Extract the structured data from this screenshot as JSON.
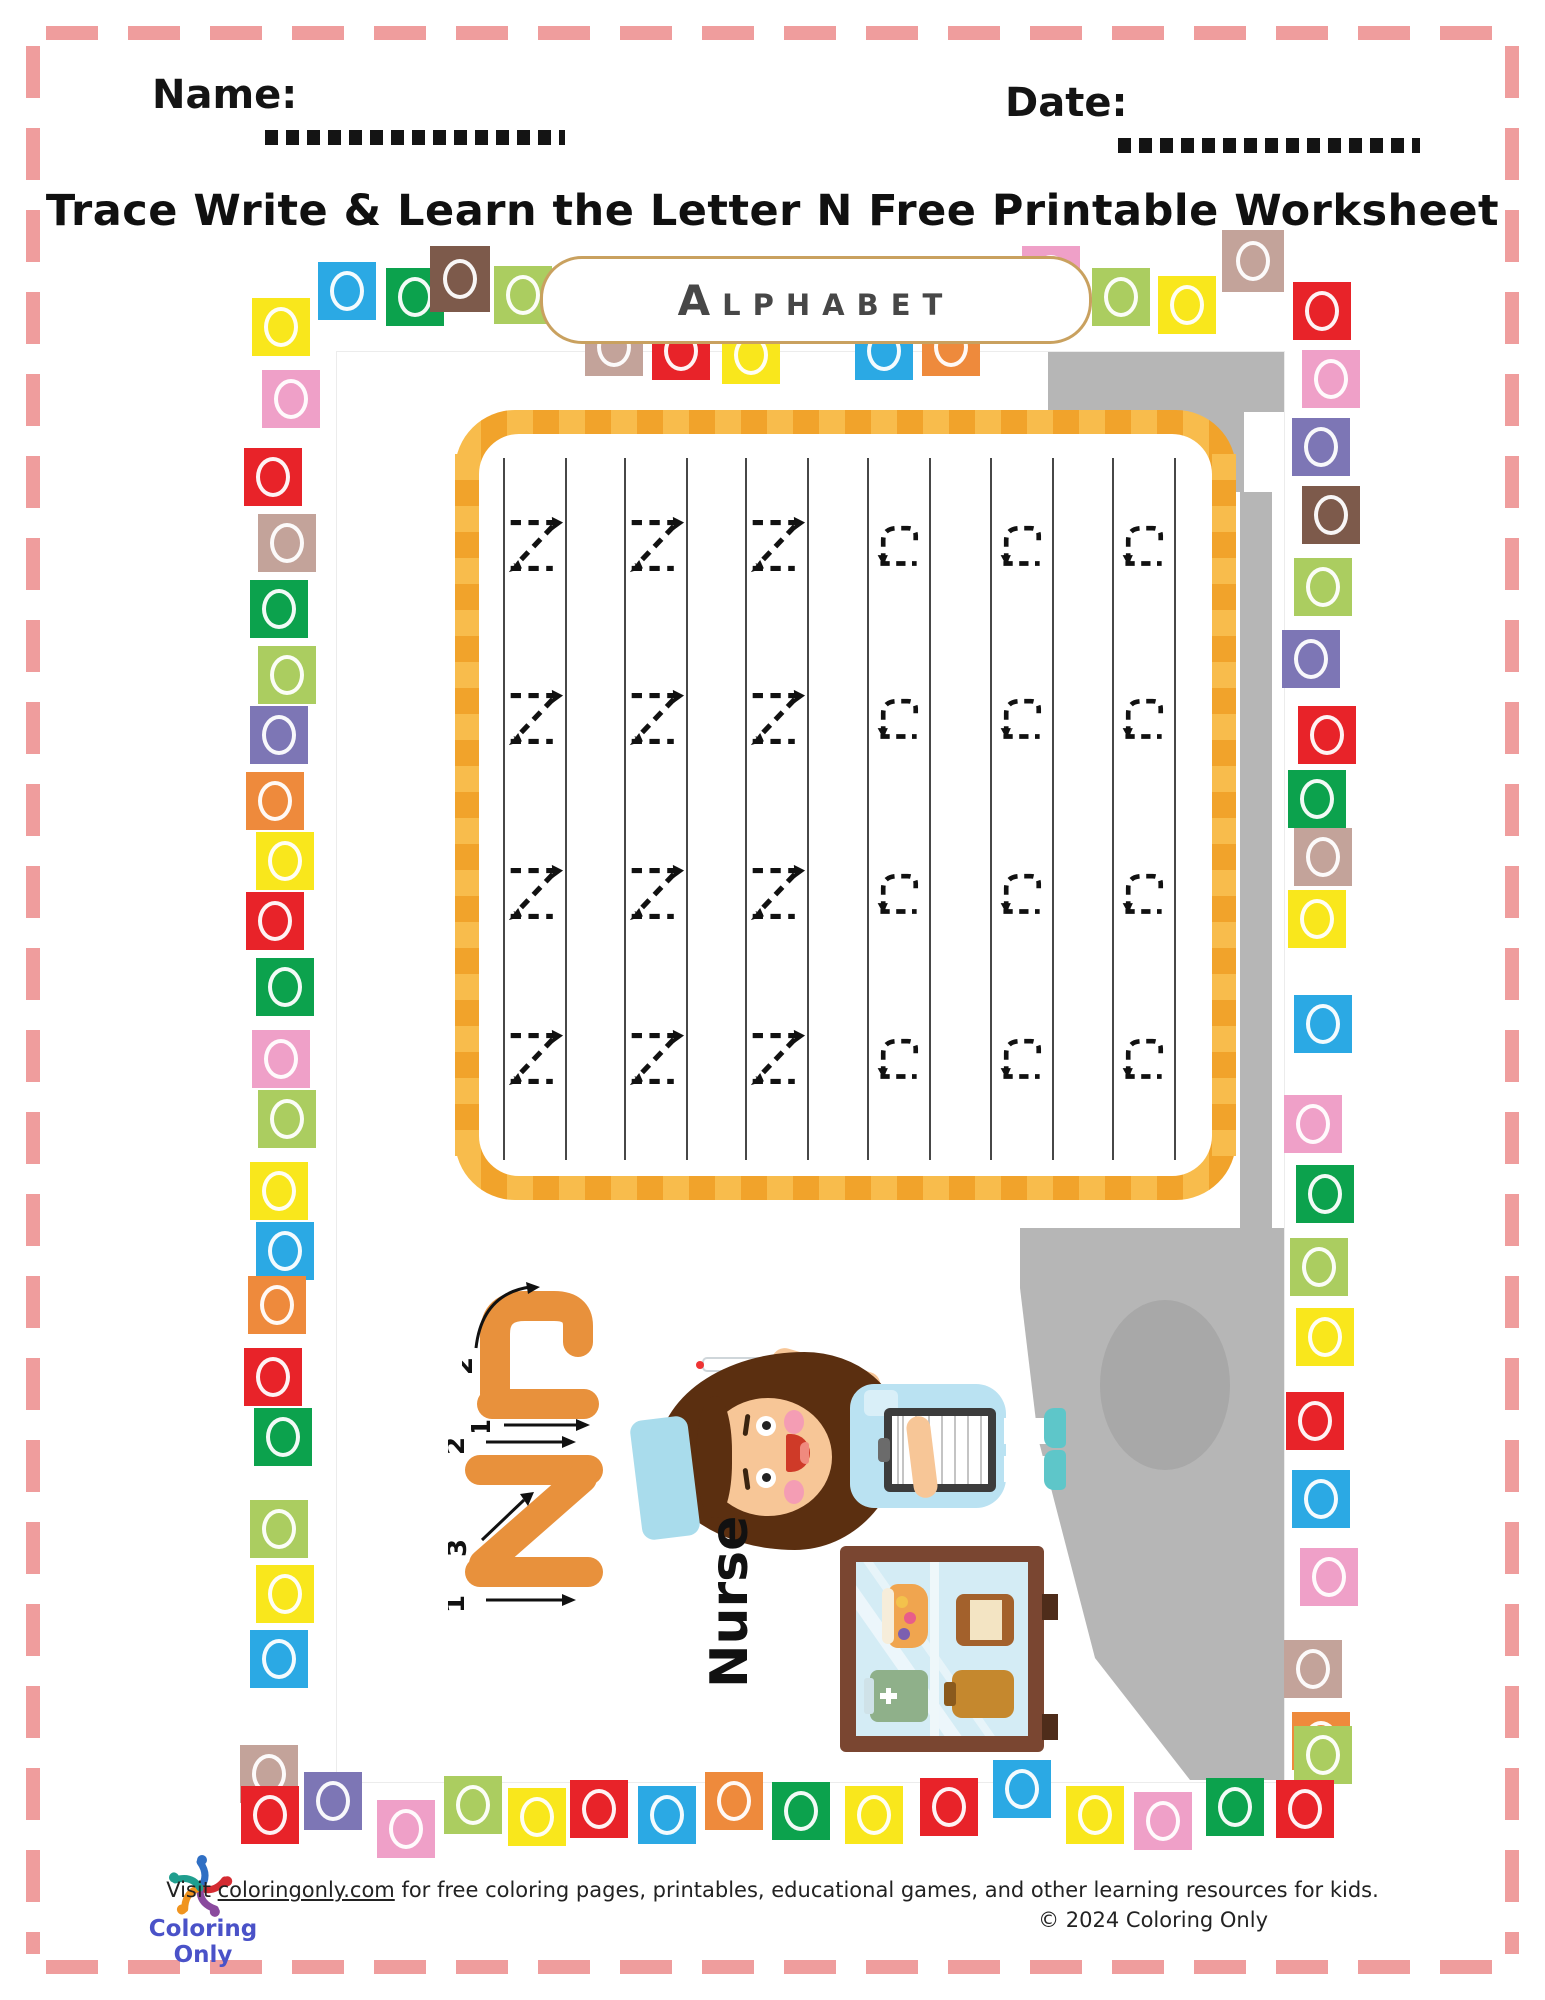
{
  "header": {
    "name_label": "Name:",
    "date_label": "Date:",
    "title": "Trace Write & Learn the Letter N Free Printable Worksheet"
  },
  "banner": {
    "label": "Alphabet"
  },
  "trace_grid": {
    "columns": [
      "N",
      "N",
      "N",
      "n",
      "n",
      "n"
    ],
    "rows_per_column": 4,
    "uppercase_letter": "N",
    "lowercase_letter": "n"
  },
  "letter_guide": {
    "uppercase": "N",
    "lowercase": "n",
    "upper_stroke_numbers": [
      "1",
      "2",
      "3"
    ],
    "lower_stroke_numbers": [
      "1",
      "2"
    ],
    "word": "Nurse"
  },
  "colors": {
    "theme": {
      "pink": "#ef9d9d",
      "orange1": "#f8bc4c",
      "orange2": "#f1a32b",
      "guide-orange": "#e8913c"
    },
    "blocks": {
      "yellow": "#f9e71c",
      "blue": "#2ba9e4",
      "green": "#0ca24d",
      "brown": "#7d5a4b",
      "lightgreen": "#abcd60",
      "pink": "#efa0c8",
      "red": "#e82329",
      "tan": "#c3a39a",
      "purple": "#7d76b5",
      "orange": "#ee8a3c"
    }
  },
  "blocks": {
    "top": [
      [
        "blue",
        318,
        262
      ],
      [
        "green",
        386,
        268
      ],
      [
        "brown",
        430,
        246,
        60,
        66
      ],
      [
        "lightgreen",
        494,
        266
      ],
      [
        "tan",
        585,
        318
      ],
      [
        "red",
        652,
        322
      ],
      [
        "yellow",
        722,
        326
      ],
      [
        "blue",
        855,
        322
      ],
      [
        "orange",
        922,
        318
      ],
      [
        "pink",
        1022,
        246
      ],
      [
        "lightgreen",
        1092,
        268
      ],
      [
        "yellow",
        1158,
        276
      ],
      [
        "tan",
        1222,
        230,
        62,
        62
      ]
    ],
    "left_column": [
      [
        "yellow",
        252,
        298
      ],
      [
        "pink",
        262,
        370
      ],
      [
        "red",
        244,
        448
      ],
      [
        "tan",
        258,
        514
      ],
      [
        "green",
        250,
        580
      ],
      [
        "lightgreen",
        258,
        646
      ],
      [
        "purple",
        250,
        706
      ],
      [
        "orange",
        246,
        772
      ],
      [
        "yellow",
        256,
        832
      ],
      [
        "red",
        246,
        892
      ],
      [
        "green",
        256,
        958
      ],
      [
        "pink",
        252,
        1030
      ],
      [
        "lightgreen",
        258,
        1090
      ],
      [
        "yellow",
        250,
        1162
      ],
      [
        "blue",
        256,
        1222
      ],
      [
        "orange",
        248,
        1276
      ],
      [
        "red",
        244,
        1348
      ],
      [
        "green",
        254,
        1408
      ],
      [
        "lightgreen",
        250,
        1500
      ],
      [
        "yellow",
        256,
        1565
      ],
      [
        "blue",
        250,
        1630
      ],
      [
        "tan",
        240,
        1745
      ]
    ],
    "right_column": [
      [
        "red",
        1293,
        282
      ],
      [
        "pink",
        1302,
        350
      ],
      [
        "purple",
        1292,
        418
      ],
      [
        "brown",
        1302,
        486
      ],
      [
        "lightgreen",
        1294,
        558
      ],
      [
        "purple",
        1282,
        630
      ],
      [
        "red",
        1298,
        706
      ],
      [
        "green",
        1288,
        770
      ],
      [
        "tan",
        1294,
        828
      ],
      [
        "yellow",
        1288,
        890
      ],
      [
        "blue",
        1294,
        995
      ],
      [
        "pink",
        1284,
        1095
      ],
      [
        "green",
        1296,
        1165
      ],
      [
        "lightgreen",
        1290,
        1238
      ],
      [
        "yellow",
        1296,
        1308
      ],
      [
        "red",
        1286,
        1392
      ],
      [
        "blue",
        1292,
        1470
      ],
      [
        "pink",
        1300,
        1548
      ],
      [
        "tan",
        1284,
        1640
      ],
      [
        "orange",
        1292,
        1712
      ],
      [
        "lightgreen",
        1294,
        1726
      ]
    ],
    "bottom_row": [
      [
        "red",
        241,
        1786
      ],
      [
        "purple",
        304,
        1772
      ],
      [
        "pink",
        377,
        1800
      ],
      [
        "lightgreen",
        444,
        1776
      ],
      [
        "yellow",
        508,
        1788
      ],
      [
        "red",
        570,
        1780
      ],
      [
        "blue",
        638,
        1786
      ],
      [
        "orange",
        705,
        1772
      ],
      [
        "green",
        772,
        1782
      ],
      [
        "yellow",
        845,
        1786
      ],
      [
        "red",
        920,
        1778
      ],
      [
        "blue",
        993,
        1760
      ],
      [
        "yellow",
        1066,
        1786
      ],
      [
        "pink",
        1134,
        1792
      ],
      [
        "green",
        1206,
        1778
      ],
      [
        "red",
        1276,
        1780
      ]
    ]
  },
  "footer": {
    "visit_prefix": "Visit ",
    "link_text": "coloringonly.com",
    "visit_suffix": " for free coloring pages, printables, educational games, and other learning resources for kids.",
    "copyright": "© 2024 Coloring Only",
    "logo_text": "Coloring Only"
  }
}
